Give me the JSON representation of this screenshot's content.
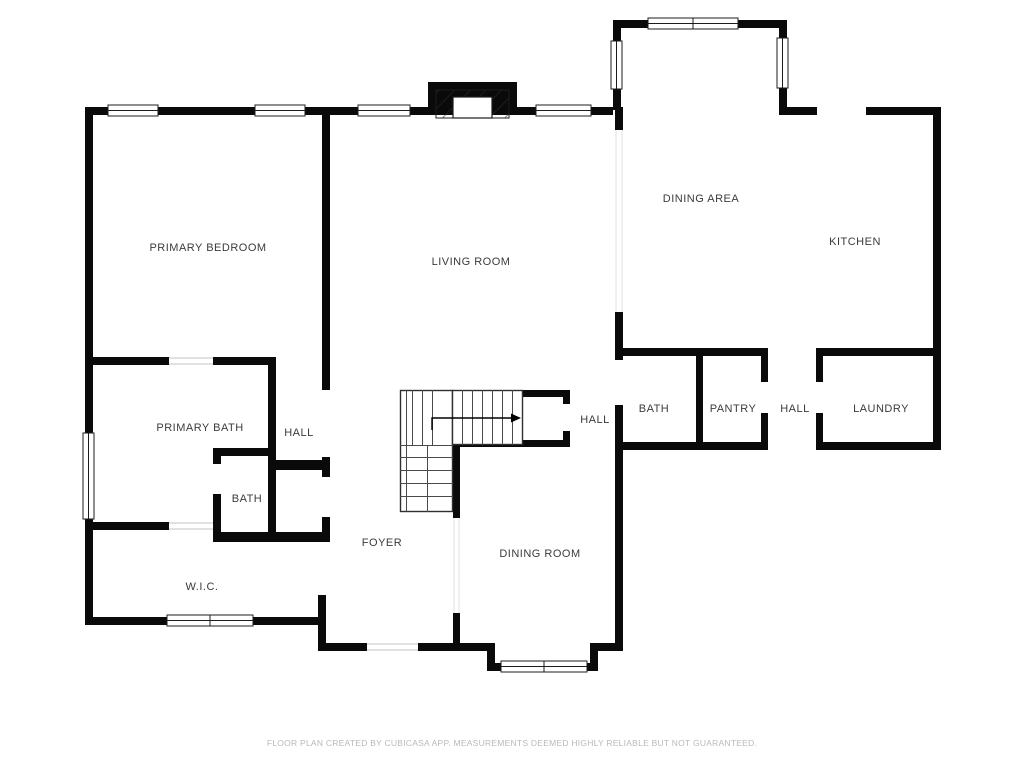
{
  "plan": {
    "app_attribution": "CubiCasa",
    "rooms": [
      {
        "label": "PRIMARY BEDROOM",
        "x": 208,
        "y": 248
      },
      {
        "label": "LIVING ROOM",
        "x": 471,
        "y": 262
      },
      {
        "label": "DINING AREA",
        "x": 701,
        "y": 199
      },
      {
        "label": "KITCHEN",
        "x": 855,
        "y": 242
      },
      {
        "label": "PRIMARY BATH",
        "x": 200,
        "y": 428
      },
      {
        "label": "HALL",
        "x": 299,
        "y": 433
      },
      {
        "label": "BATH",
        "x": 247,
        "y": 499
      },
      {
        "label": "W.I.C.",
        "x": 202,
        "y": 587
      },
      {
        "label": "FOYER",
        "x": 382,
        "y": 543
      },
      {
        "label": "DINING ROOM",
        "x": 540,
        "y": 554
      },
      {
        "label": "HALL",
        "x": 595,
        "y": 420
      },
      {
        "label": "BATH",
        "x": 654,
        "y": 409
      },
      {
        "label": "PANTRY",
        "x": 733,
        "y": 409
      },
      {
        "label": "HALL",
        "x": 795,
        "y": 409
      },
      {
        "label": "LAUNDRY",
        "x": 881,
        "y": 409
      }
    ]
  },
  "footer": {
    "text": "FLOOR PLAN CREATED BY CUBICASA APP. MEASUREMENTS DEEMED HIGHLY RELIABLE BUT NOT GUARANTEED."
  },
  "colors": {
    "wall": "#0a0a0a",
    "label": "#3b3b3b",
    "footer": "#b9b9b9",
    "background": "#ffffff"
  }
}
